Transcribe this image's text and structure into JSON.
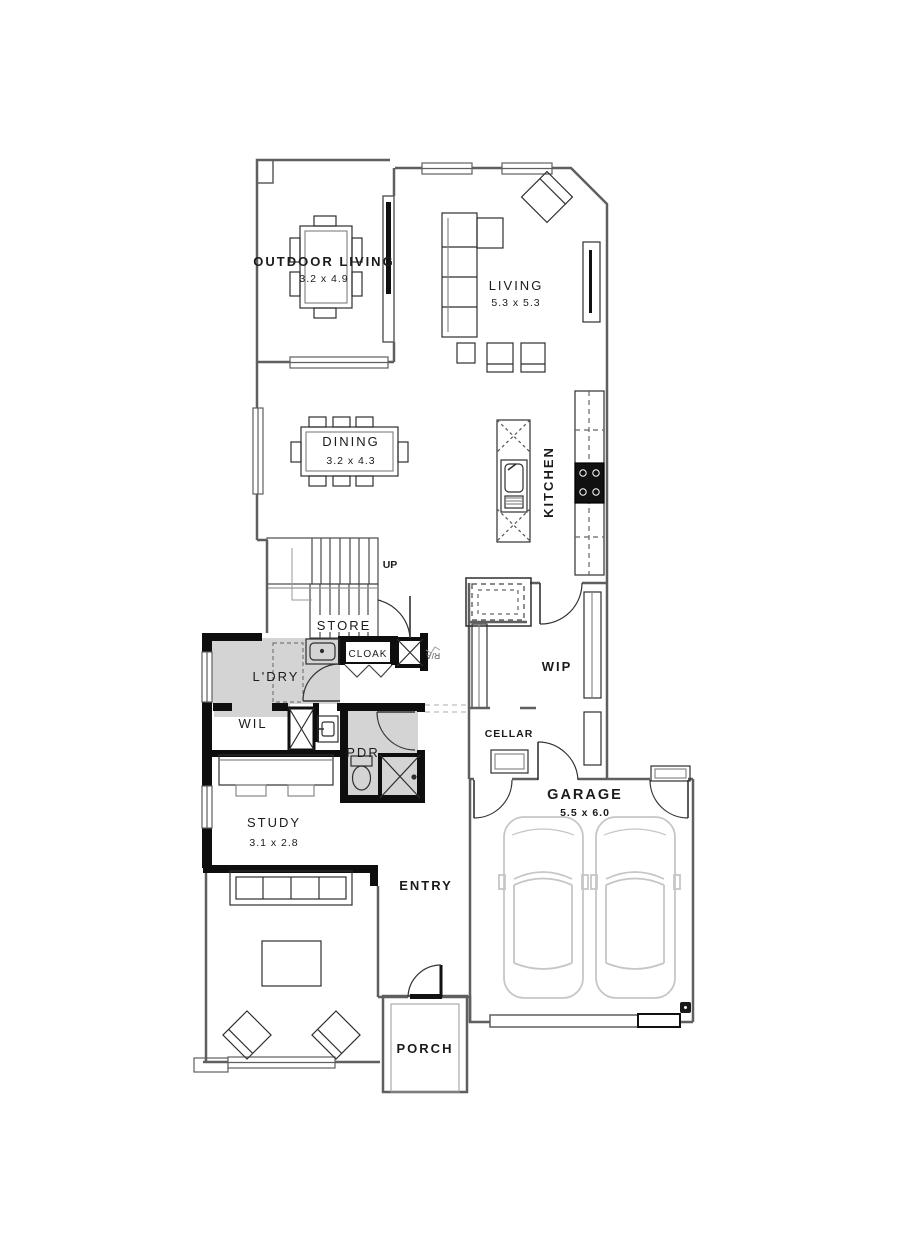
{
  "plan_type": "floor-plan",
  "rooms": {
    "outdoor_living": {
      "label": "OUTDOOR LIVING",
      "dims": "3.2 x 4.9"
    },
    "living": {
      "label": "LIVING",
      "dims": "5.3 x 5.3"
    },
    "dining": {
      "label": "DINING",
      "dims": "3.2 x 4.3"
    },
    "kitchen": {
      "label": "KITCHEN"
    },
    "stairs": {
      "label": "UP"
    },
    "store": {
      "label": "STORE"
    },
    "cloak": {
      "label": "CLOAK"
    },
    "return_air": {
      "label": "R/A"
    },
    "laundry": {
      "label": "L'DRY"
    },
    "walk_in_linen": {
      "label": "WIL"
    },
    "powder": {
      "label": "PDR"
    },
    "walk_in_pantry": {
      "label": "WIP"
    },
    "cellar": {
      "label": "CELLAR"
    },
    "study": {
      "label": "STUDY",
      "dims": "3.1 x 2.8"
    },
    "entry": {
      "label": "ENTRY"
    },
    "garage": {
      "label": "GARAGE",
      "dims": "5.5 x 6.0"
    },
    "porch": {
      "label": "PORCH"
    }
  },
  "colors": {
    "background": "#ffffff",
    "wall_heavy": "#0e0e0e",
    "wall_light": "#5f5f5f",
    "furniture_line": "#2e2e2e",
    "floor_shade": "#d4d4d4",
    "car_line": "#c6c6c6",
    "label_text": "#1b1b1b"
  }
}
